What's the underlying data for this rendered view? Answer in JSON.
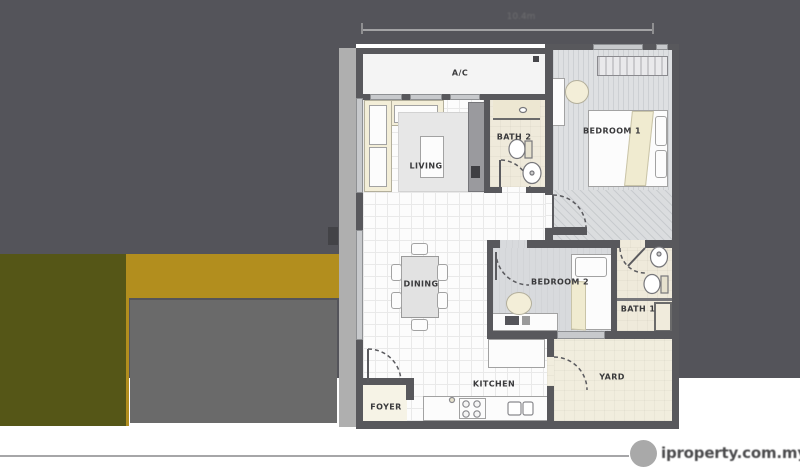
{
  "floorplan": {
    "rooms": {
      "ac": "A/C",
      "living": "LIVING",
      "bath2": "BATH 2",
      "bedroom1": "BEDROOM 1",
      "dining": "DINING",
      "bedroom2": "BEDROOM 2",
      "bath1": "BATH 1",
      "kitchen": "KITCHEN",
      "yard": "YARD",
      "foyer": "FOYER"
    },
    "dimension": {
      "label": "10.4m"
    }
  },
  "watermark": {
    "text": "iproperty.com.my"
  },
  "colors": {
    "panel_gray": "#54545A",
    "olive_block": "#555617",
    "gold_block": "#B28E1E",
    "gray_block": "#6A6A6A",
    "light_strip": "#AFAFAF",
    "wall": "#58585C",
    "cream_floor": "#EFEADB",
    "bedroom_floor": "#DDE0E2"
  }
}
